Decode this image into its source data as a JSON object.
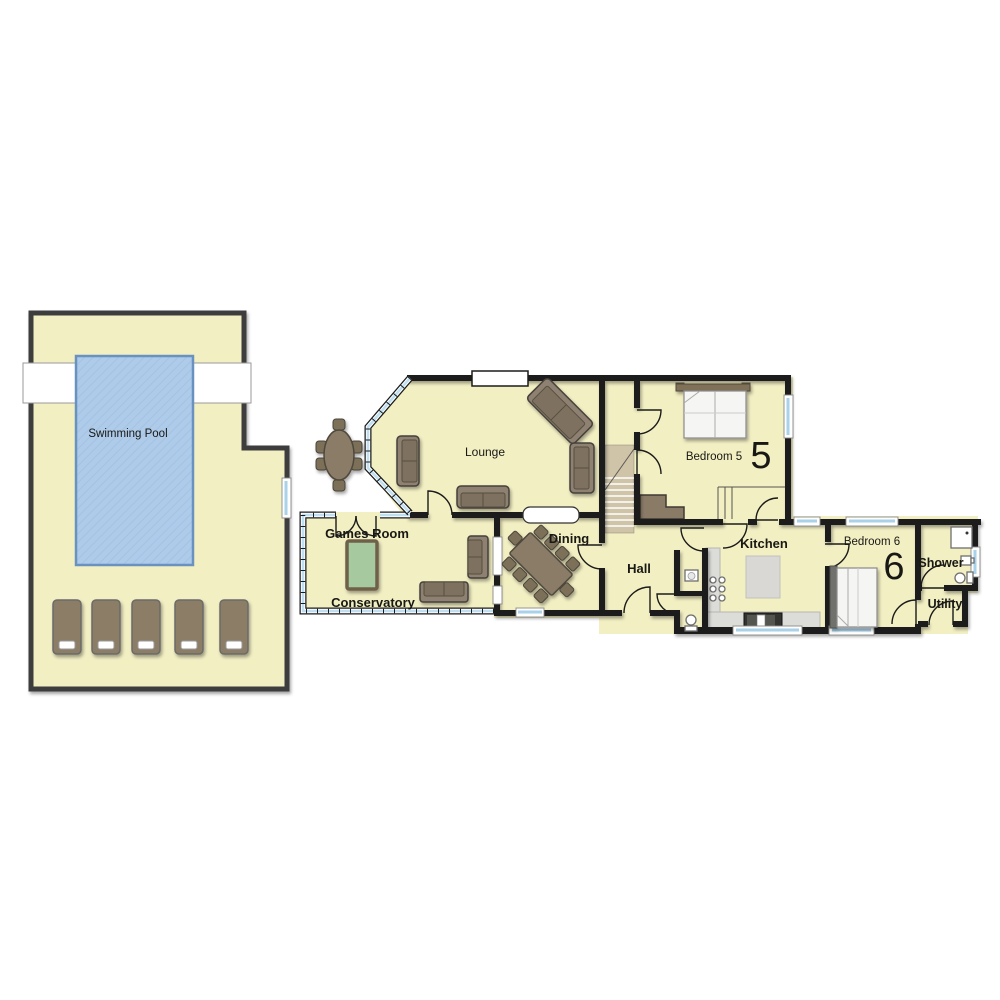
{
  "rooms": {
    "swimming_pool": {
      "label": "Swimming Pool"
    },
    "lounge": {
      "label": "Lounge"
    },
    "games_room": {
      "label": "Games Room"
    },
    "conservatory": {
      "label": "Conservatory"
    },
    "dining": {
      "label": "Dining"
    },
    "hall": {
      "label": "Hall"
    },
    "kitchen": {
      "label": "Kitchen"
    },
    "bedroom_5": {
      "label": "Bedroom 5",
      "number": "5"
    },
    "bedroom_6": {
      "label": "Bedroom 6",
      "number": "6"
    },
    "shower": {
      "label": "Shower"
    },
    "utility": {
      "label": "Utility"
    }
  },
  "colors": {
    "floor": "#f2efc3",
    "wall": "#1b1b1a",
    "pool_water": "#aecbe9",
    "glazing": "#bfe0f2",
    "furniture_brown": "#8f8171",
    "counter_grey": "#dcdcd8",
    "stair_tan": "#cfc3a8",
    "games_table_green": "#a6c9a0"
  }
}
